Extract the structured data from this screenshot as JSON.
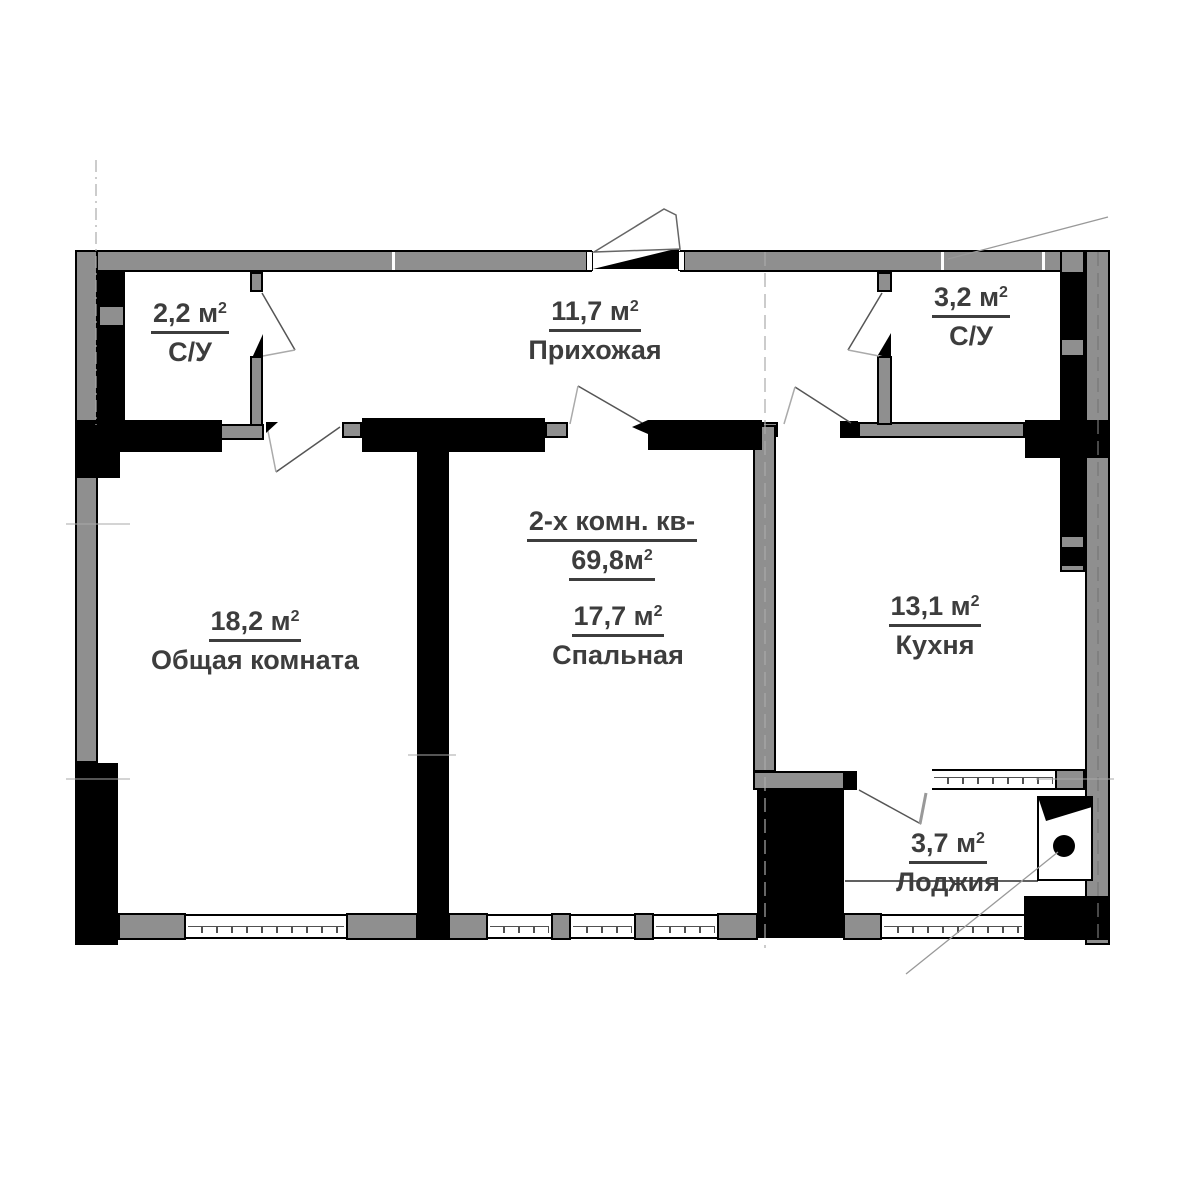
{
  "plan": {
    "title_line": "2-х комн. кв-",
    "total_area": "69,8м",
    "sup": "2",
    "rooms": [
      {
        "area": "2,2 м",
        "sup": "2",
        "name": "С/У"
      },
      {
        "area": "11,7 м",
        "sup": "2",
        "name": "Прихожая"
      },
      {
        "area": "3,2 м",
        "sup": "2",
        "name": "С/У"
      },
      {
        "area": "18,2 м",
        "sup": "2",
        "name": "Общая комната"
      },
      {
        "area": "17,7 м",
        "sup": "2",
        "name": "Спальная"
      },
      {
        "area": "13,1 м",
        "sup": "2",
        "name": "Кухня"
      },
      {
        "area": "3,7 м",
        "sup": "2",
        "name": "Лоджия"
      }
    ],
    "colors": {
      "wall_gray": "#8f8f8f",
      "wall_black": "#000000",
      "text": "#3d3d3d",
      "background": "#ffffff",
      "line_gray": "#9a9a9a"
    }
  }
}
